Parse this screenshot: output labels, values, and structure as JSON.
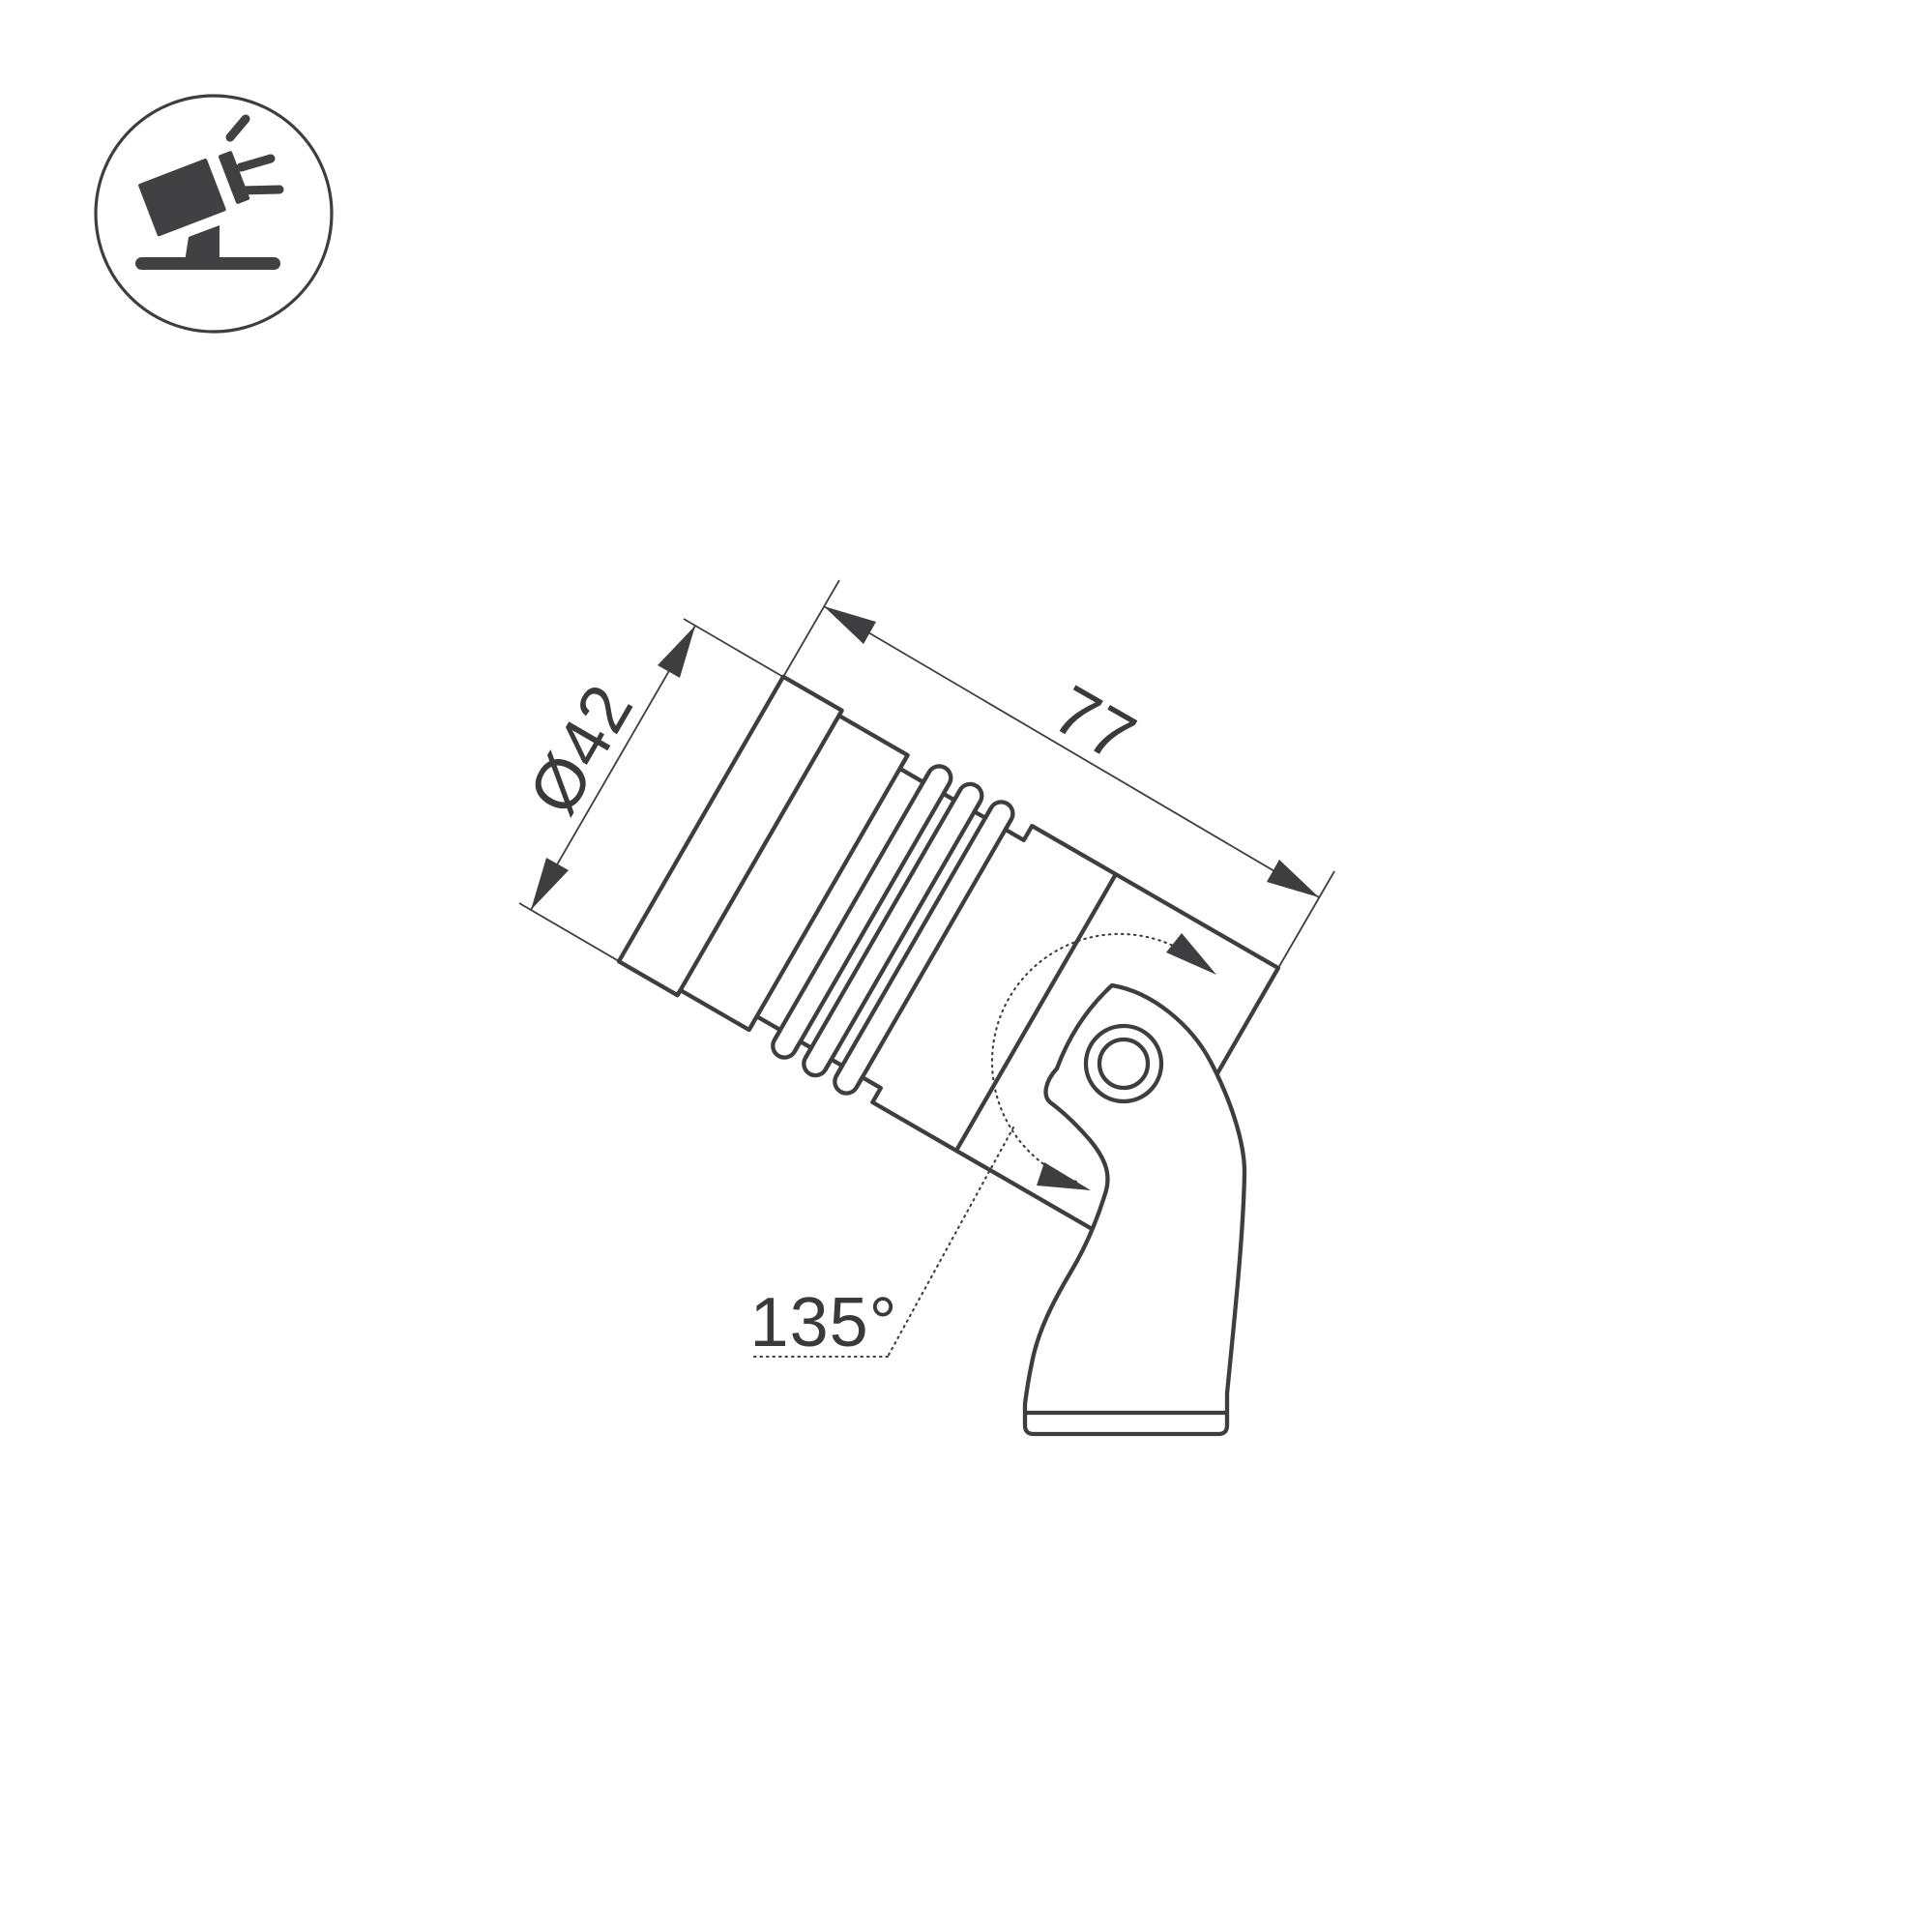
{
  "page": {
    "background_color": "#ffffff",
    "line_color": "#3e3e41",
    "text_color": "#3a3a3d"
  },
  "badge": {
    "icon": "tilted-spotlight-on-stand-icon"
  },
  "drawing": {
    "subject": "adjustable spotlight side-view dimension drawing",
    "dimensions": {
      "diameter": {
        "label": "Ø42",
        "value": 42
      },
      "length": {
        "label": "77",
        "value": 77
      },
      "rotation_angle": {
        "label": "135°",
        "value": 135
      }
    }
  }
}
